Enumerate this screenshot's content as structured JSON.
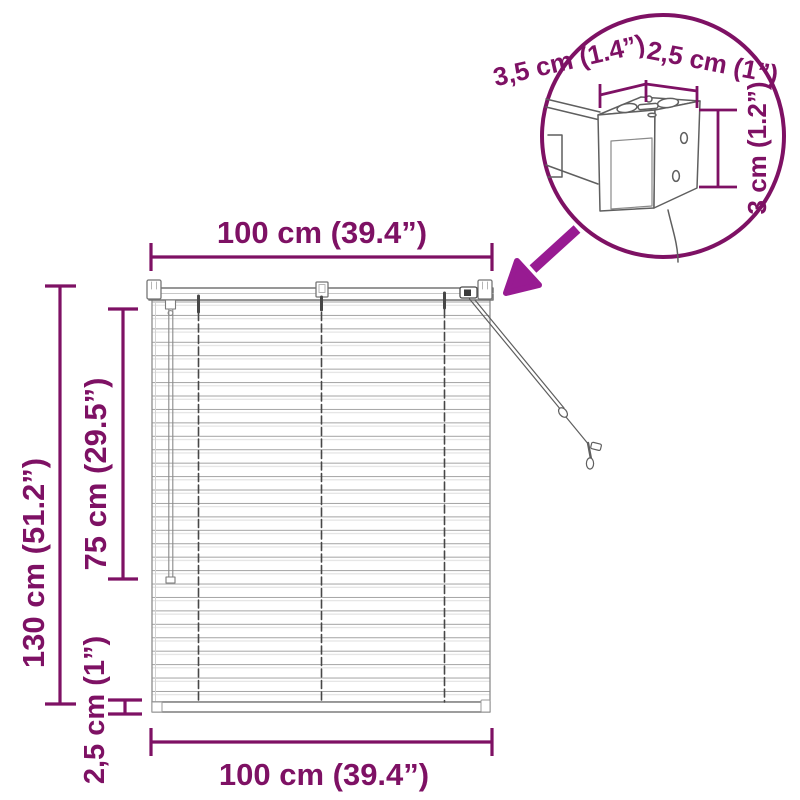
{
  "diagram": {
    "title": "window-blind-dimension-diagram",
    "colors": {
      "dimension_purple": "#7e1164",
      "arrow_magenta": "#981b92",
      "drawing_gray": "#6f6f6f"
    },
    "dimensions": {
      "top_width": "100 cm (39.4”)",
      "height_total": "130 cm (51.2”)",
      "height_inner": "75 cm (29.5”)",
      "bottom_rail_height": "2,5 cm (1”)",
      "bottom_width": "100 cm (39.4”)"
    },
    "detail": {
      "depth": "3,5 cm (1.4”)",
      "width": "2,5 cm (1”)",
      "height": "3 cm (1.2”)"
    }
  }
}
